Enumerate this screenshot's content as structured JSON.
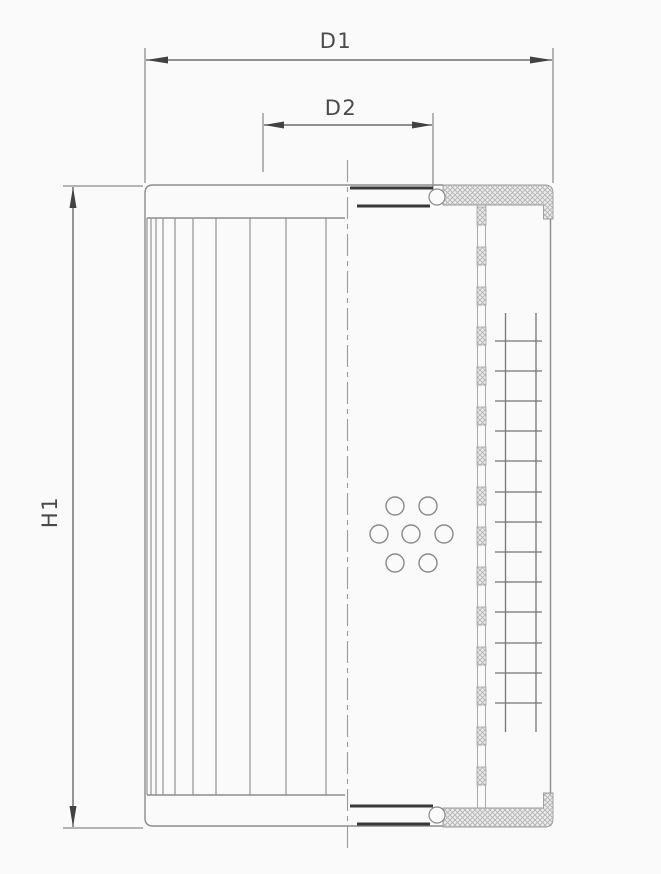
{
  "drawing": {
    "labels": {
      "d1": "D1",
      "d2": "D2",
      "h1": "H1"
    },
    "colors": {
      "background": "#fafafa",
      "body_line": "#8c8c8c",
      "dimension_line": "#525252",
      "dark_edge": "#383838",
      "hatch": "#b3b3b3",
      "label_text": "#4a4a4a"
    },
    "figure": {
      "pleats": {
        "x_positions": [
          147,
          151,
          156,
          163,
          175,
          193,
          216,
          250,
          286,
          326
        ],
        "top_y": 218,
        "bottom_y": 795
      },
      "mesh": {
        "row_y": [
          341,
          371,
          401,
          431,
          461,
          492,
          522,
          552,
          582,
          612,
          643,
          673,
          703
        ],
        "row_x1": 495,
        "row_x2": 542,
        "col_x": [
          505.5,
          536
        ],
        "col_y1": 313,
        "col_y2": 732
      },
      "core": {
        "x": 477,
        "width": 9,
        "start_y": 207,
        "end_y": 800,
        "block_height": 18,
        "period": 40
      },
      "holes": {
        "radius": 9,
        "centers": [
          [
            395,
            506
          ],
          [
            428,
            506
          ],
          [
            379,
            534
          ],
          [
            411,
            534
          ],
          [
            444,
            534
          ],
          [
            395,
            563
          ],
          [
            428,
            563
          ]
        ]
      }
    }
  }
}
